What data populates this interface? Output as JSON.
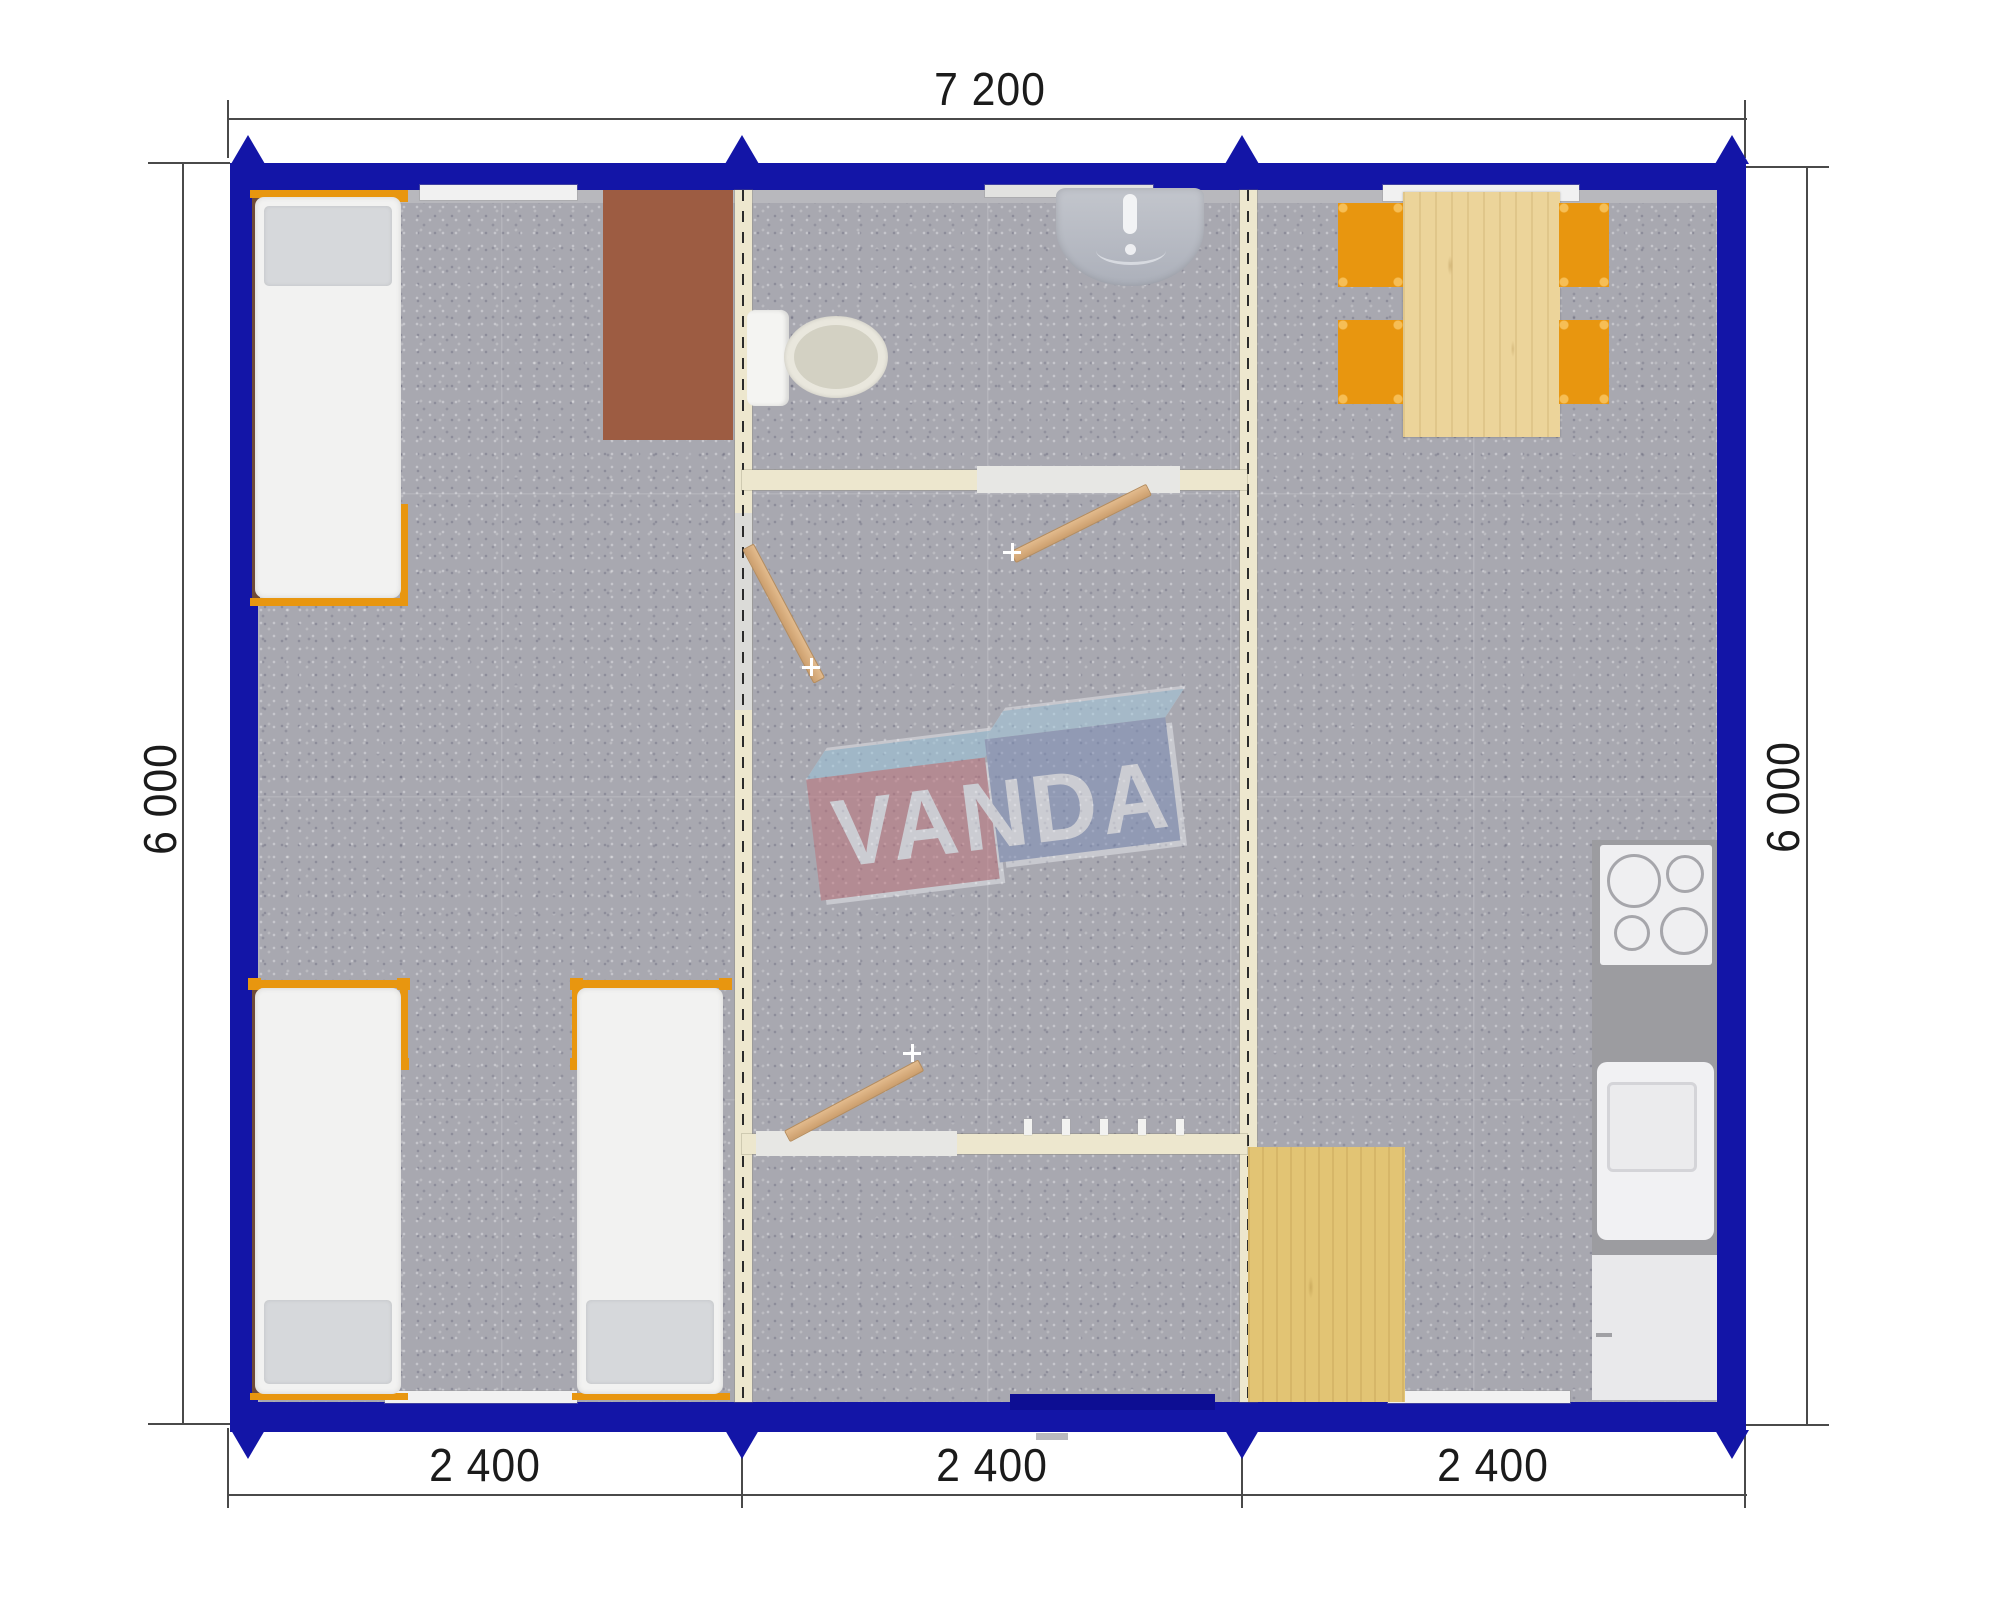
{
  "plan": {
    "type": "modular-house-floor-plan",
    "watermark_text": "VANDA",
    "dims": {
      "top_width": "7 200",
      "left_height": "6 000",
      "right_height": "6 000",
      "modules": [
        "2 400",
        "2 400",
        "2 400"
      ]
    },
    "colors": {
      "outer_wall": "#1315A7",
      "partition": "#EDE7CE",
      "floor_carpet": "#A8A8B0",
      "furniture_orange": "#E8960F",
      "wood_table": "#ECD49A",
      "wood_mat": "#E2C474",
      "desk_brown": "#9D5C42",
      "kitchen_counter": "#9C9CA0",
      "door_leaf": "#D9AE7E",
      "logo_red": "#BF6F78",
      "logo_blue": "#7B8DB8",
      "logo_sky": "#9CC8DE"
    },
    "rooms": {
      "left_module": [
        "single-bed",
        "single-bed",
        "single-bed",
        "desk"
      ],
      "middle_module": [
        "toilet",
        "wash-basin",
        "coat-hooks",
        "entrance-door"
      ],
      "right_module": [
        "dining-table",
        "four-chairs",
        "cooktop",
        "kitchen-sink",
        "fridge",
        "wood-floor-mat"
      ]
    }
  }
}
